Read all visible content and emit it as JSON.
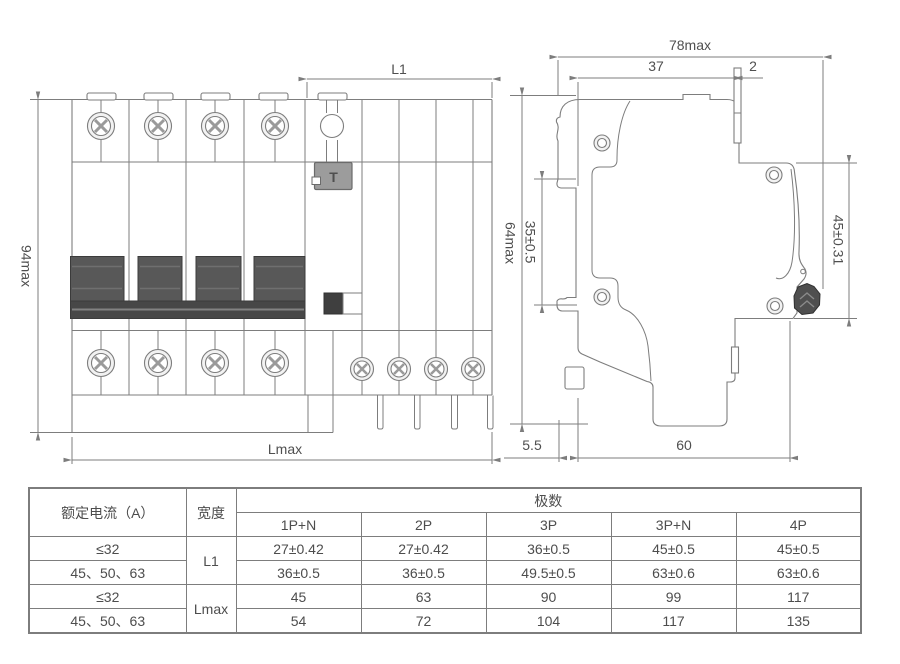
{
  "drawing": {
    "front_view": {
      "label_l1": "L1",
      "label_height": "94max",
      "label_lmax": "Lmax",
      "test_button": "T"
    },
    "side_view": {
      "label_width": "78max",
      "label_37": "37",
      "label_2": "2",
      "label_height": "64max",
      "label_rail": "35±0.5",
      "label_front": "45±0.31",
      "label_5_5": "5.5",
      "label_60": "60"
    }
  },
  "table": {
    "header": {
      "col1": "额定电流（A）",
      "col2": "宽度",
      "group": "极数",
      "poles": [
        "1P+N",
        "2P",
        "3P",
        "3P+N",
        "4P"
      ]
    },
    "rows": [
      {
        "current": "≤32",
        "width": "L1",
        "values": [
          "27±0.42",
          "27±0.42",
          "36±0.5",
          "45±0.5",
          "45±0.5"
        ]
      },
      {
        "current": "45、50、63",
        "values": [
          "36±0.5",
          "36±0.5",
          "49.5±0.5",
          "63±0.6",
          "63±0.6"
        ]
      },
      {
        "current": "≤32",
        "width": "Lmax",
        "values": [
          "45",
          "63",
          "90",
          "99",
          "117"
        ]
      },
      {
        "current": "45、50、63",
        "values": [
          "54",
          "72",
          "104",
          "117",
          "135"
        ]
      }
    ]
  }
}
